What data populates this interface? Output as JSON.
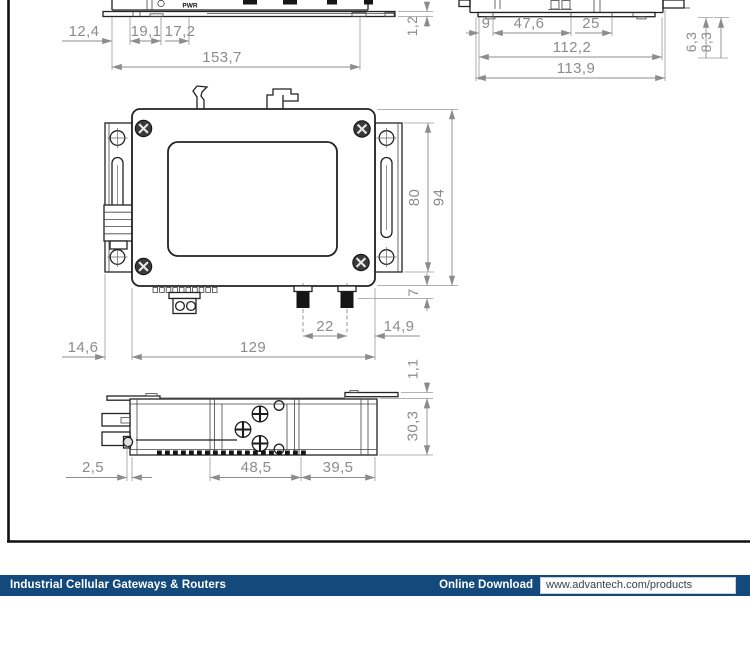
{
  "drawing": {
    "top_front_view": {
      "panel_label": "PWR",
      "dims": {
        "d1": "12,4",
        "d2": "19,1",
        "d3": "17,2",
        "total": "153,7"
      }
    },
    "top_side_view": {
      "dims": {
        "plate": "1,2",
        "left": "9",
        "mid": "47,6",
        "right": "25",
        "inner": "112,2",
        "outer": "113,9",
        "v1": "6,3",
        "v2": "8,3"
      }
    },
    "front_view": {
      "dims": {
        "bracket": "14,6",
        "width": "129",
        "ant_pitch": "22",
        "ant_edge": "14,9",
        "bracket_h": "80",
        "height": "94",
        "conn": "7"
      }
    },
    "bottom_view": {
      "dims": {
        "edge": "2,5",
        "mid": "48,5",
        "right": "39,5",
        "depth": "30,3",
        "plate": "1,1"
      }
    }
  },
  "footer": {
    "bar_color": "#14497C",
    "category": "Industrial Cellular Gateways & Routers",
    "download_label": "Online Download",
    "url": "www.advantech.com/products"
  }
}
